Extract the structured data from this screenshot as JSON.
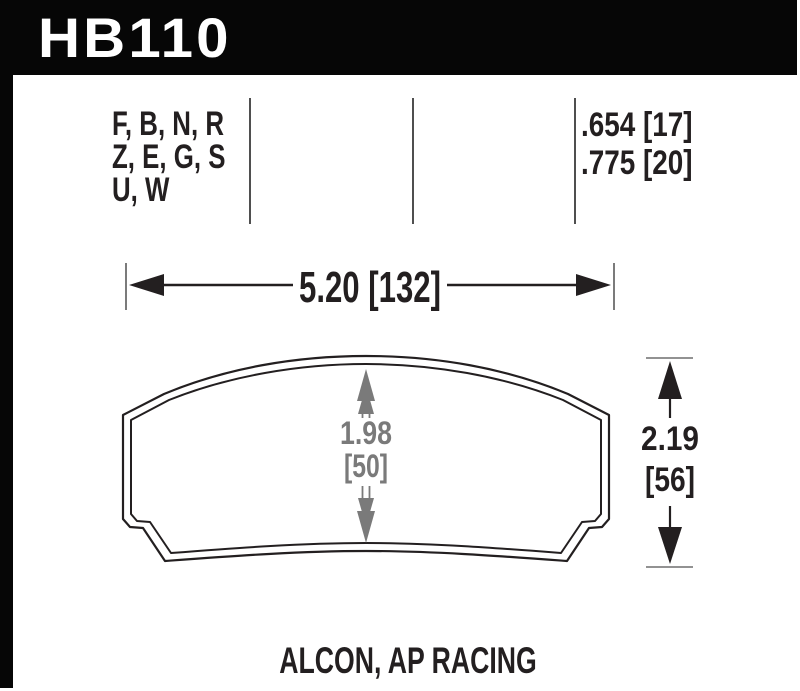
{
  "part": {
    "number": "HB110"
  },
  "compound_table": {
    "compound_codes_lines": [
      "F, B, N, R",
      "Z, E, G, S",
      "U, W"
    ],
    "middle_cells": [
      "",
      ""
    ],
    "pad_thickness_lines": [
      ".654 [17]",
      ".775 [20]"
    ]
  },
  "dimensions": {
    "width_label": "5.20 [132]",
    "center_height_value": "1.98",
    "center_height_mm": "[50]",
    "overall_height_value": "2.19",
    "overall_height_mm": "[56]"
  },
  "footer": {
    "applications": "ALCON, AP RACING"
  },
  "colors": {
    "header_bg": "#060606",
    "ink": "#231f20",
    "dimension_gray": "#7a7a7a"
  }
}
